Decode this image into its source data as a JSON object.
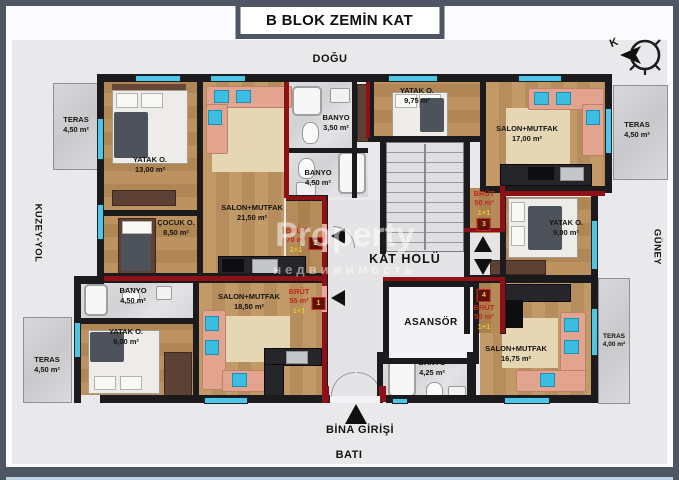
{
  "title": "B BLOK ZEMİN KAT",
  "directions": {
    "top": "DOĞU",
    "bottom": "BATI",
    "left": "KUZEY-YOL",
    "right": "GÜNEY"
  },
  "compass": {
    "north_label": "K"
  },
  "entrance_label": "BİNA GİRİŞİ",
  "core": {
    "hall": "KAT HOLÜ",
    "elevator": "ASANSÖR"
  },
  "watermark": {
    "line1": "Property",
    "line2": "недвижимость"
  },
  "apartments": [
    {
      "badge": "1",
      "label": "BRÜT",
      "area": "55 m²",
      "plan": "1+1"
    },
    {
      "badge": "2",
      "label": "BRÜT",
      "area": "70 m²",
      "plan": "2+1"
    },
    {
      "badge": "3",
      "label": "BRÜT",
      "area": "50 m²",
      "plan": "1+1"
    },
    {
      "badge": "4",
      "label": "BRÜT",
      "area": "50 m²",
      "plan": "1+1"
    }
  ],
  "rooms": [
    {
      "name": "TERAS",
      "area": "4,50 m²"
    },
    {
      "name": "YATAK O.",
      "area": "13,00 m²"
    },
    {
      "name": "ÇOCUK O.",
      "area": "8,50 m²"
    },
    {
      "name": "SALON+MUTFAK",
      "area": "21,50 m²"
    },
    {
      "name": "BANYO",
      "area": "3,50 m²"
    },
    {
      "name": "BANYO",
      "area": "4,50 m²"
    },
    {
      "name": "YATAK O.",
      "area": "9,75 m²"
    },
    {
      "name": "SALON+MUTFAK",
      "area": "17,00 m²"
    },
    {
      "name": "TERAS",
      "area": "4,50 m²"
    },
    {
      "name": "YATAK O.",
      "area": "9,00 m²"
    },
    {
      "name": "BANYO",
      "area": "4,50 m²"
    },
    {
      "name": "YATAK O.",
      "area": "9,00 m²"
    },
    {
      "name": "SALON+MUTFAK",
      "area": "18,50 m²"
    },
    {
      "name": "BANYO",
      "area": "4,25 m²"
    },
    {
      "name": "SALON+MUTFAK",
      "area": "16,75 m²"
    },
    {
      "name": "TERAS",
      "area": "4,00 m²"
    },
    {
      "name": "TERAS",
      "area": "4,50 m²"
    }
  ],
  "colors": {
    "accent_red": "#8e1117",
    "window_cyan": "#50c5e8",
    "label_red": "#c2281c",
    "label_yellow": "#e9c428"
  }
}
